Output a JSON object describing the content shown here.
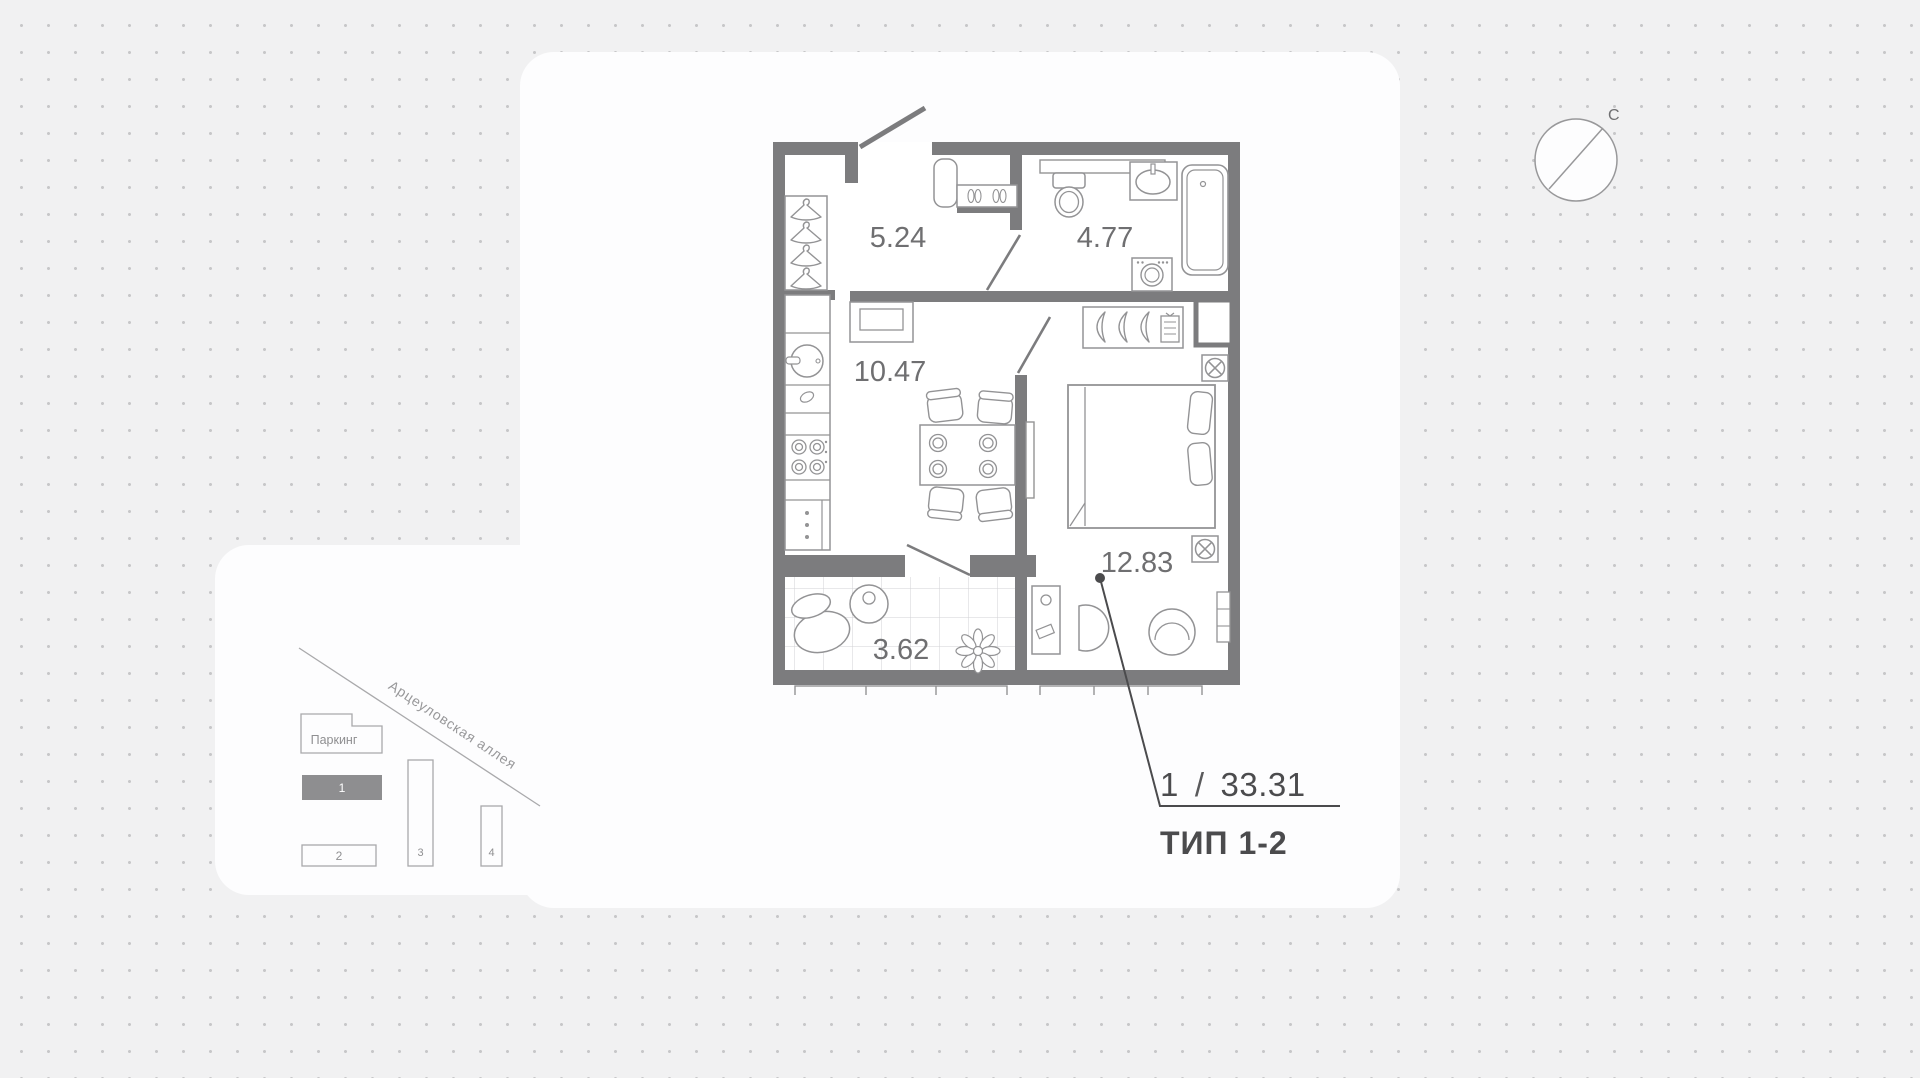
{
  "plan": {
    "rooms": [
      {
        "name": "hallway",
        "area": "5.24"
      },
      {
        "name": "bathroom",
        "area": "4.77"
      },
      {
        "name": "kitchen-living",
        "area": "10.47"
      },
      {
        "name": "bedroom",
        "area": "12.83"
      },
      {
        "name": "balcony",
        "area": "3.62"
      }
    ]
  },
  "callout": {
    "rooms_count": "1",
    "separator": "/",
    "total_area": "33.31",
    "type_label": "ТИП 1-2"
  },
  "compass": {
    "north_label": "С"
  },
  "minimap": {
    "street_name": "Арцеуловская аллея",
    "parking_label": "Паркинг",
    "buildings": [
      {
        "label": "1",
        "state": "active"
      },
      {
        "label": "2",
        "state": "default"
      },
      {
        "label": "3",
        "state": "default"
      },
      {
        "label": "4",
        "state": "default"
      }
    ]
  },
  "colors": {
    "wall": "#7c7c7e",
    "fixture": "#939395",
    "room_label": "#6f6f71",
    "accent_dark": "#4b4b4d",
    "background": "#f1f1f2",
    "dot": "#c7c7c9",
    "minimap_line": "#a9a9ab",
    "minimap_active_fill": "#8e8e90"
  }
}
